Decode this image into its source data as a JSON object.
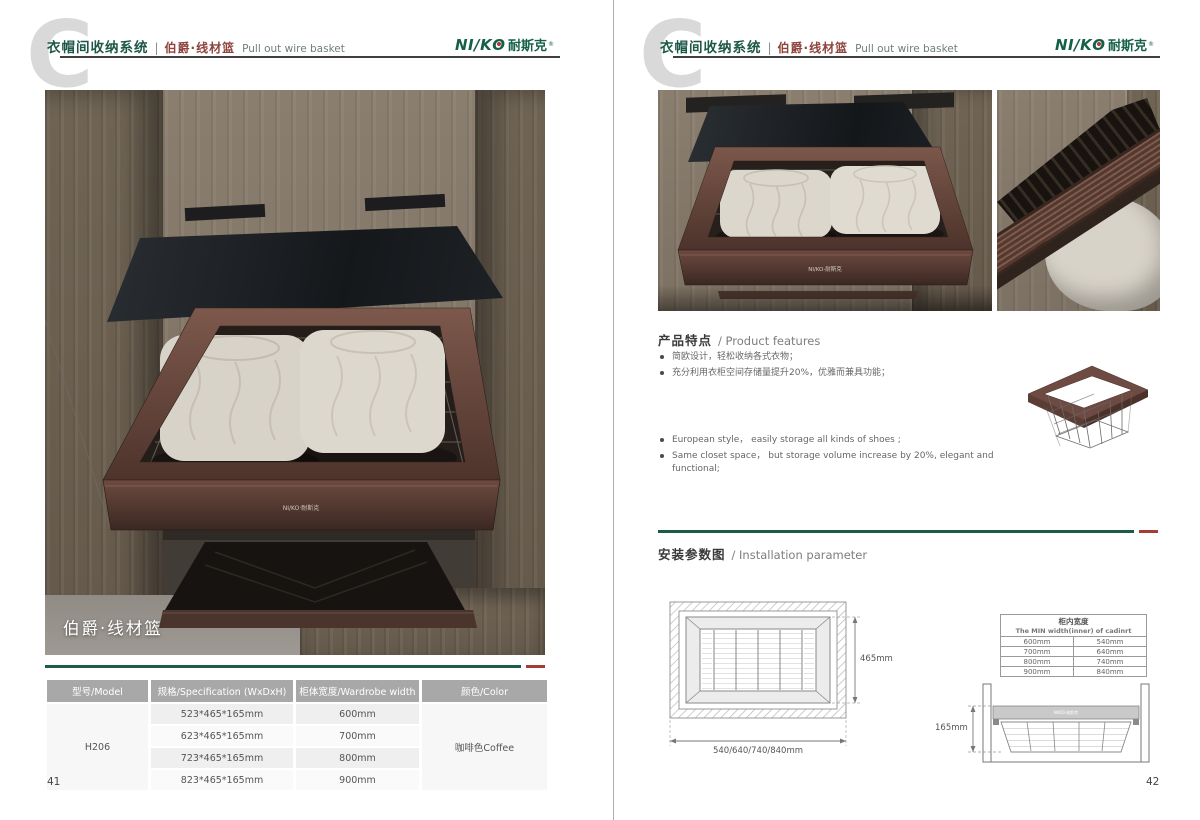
{
  "colors": {
    "brand_green": "#1d5c49",
    "accent_red": "#a63c36",
    "coffee_frame": "#6b4a42",
    "table_header_bg": "#a8a8a8"
  },
  "header": {
    "watermark_letter": "C",
    "category_cn": "衣帽间收纳系统",
    "separator": "|",
    "product_cn": "伯爵·线材篮",
    "product_en": "Pull out wire basket"
  },
  "brand": {
    "logo_en": "NI/K",
    "logo_o": "O",
    "logo_cn": "耐斯克",
    "reg_mark": "®"
  },
  "product_logo": "NI/KO·耐斯克",
  "left_page": {
    "photo_caption": "伯爵·线材篮",
    "page_number": "41",
    "table": {
      "headers": [
        "型号/Model",
        "规格/Specification (WxDxH)",
        "柜体宽度/Wardrobe width",
        "颜色/Color"
      ],
      "model": "H206",
      "color": "咖啡色Coffee",
      "rows": [
        {
          "spec": "523*465*165mm",
          "width": "600mm"
        },
        {
          "spec": "623*465*165mm",
          "width": "700mm"
        },
        {
          "spec": "723*465*165mm",
          "width": "800mm"
        },
        {
          "spec": "823*465*165mm",
          "width": "900mm"
        }
      ]
    }
  },
  "right_page": {
    "page_number": "42",
    "features": {
      "title_cn": "产品特点",
      "title_en": "/ Product features",
      "bullets_cn": [
        "简欧设计，轻松收纳各式衣物；",
        "充分利用衣柜空间存储量提升20%，优雅而兼具功能；"
      ],
      "bullets_en": [
        "European style，  easily storage all kinds of shoes ;",
        "Same closet space，  but storage volume increase by 20%, elegant and functional;"
      ]
    },
    "installation": {
      "title_cn": "安装参数图",
      "title_en": "/ Installation parameter",
      "top_view": {
        "height_label": "465mm",
        "width_label": "540/640/740/840mm"
      },
      "side_view": {
        "height_label": "165mm"
      },
      "width_table": {
        "title_cn": "柜内宽度",
        "title_en": "The MIN width(inner) of cadinrt",
        "rows": [
          [
            "600mm",
            "540mm"
          ],
          [
            "700mm",
            "640mm"
          ],
          [
            "800mm",
            "740mm"
          ],
          [
            "900mm",
            "840mm"
          ]
        ]
      }
    }
  }
}
